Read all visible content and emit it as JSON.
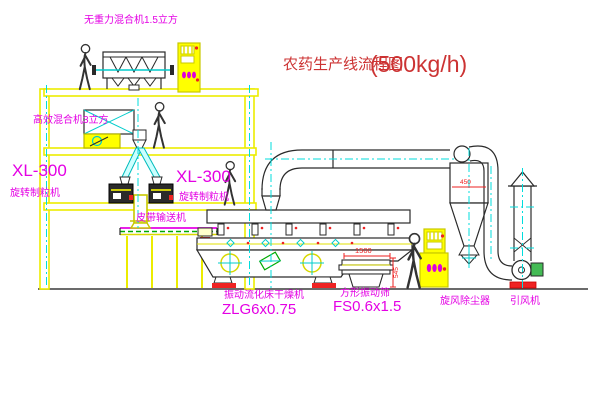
{
  "title": {
    "text": "农药生产线流程图",
    "capacity": "(500kg/h)"
  },
  "equipment": {
    "gravity_mixer": {
      "label": "无重力混合机1.5立方"
    },
    "high_efficiency_mixer": {
      "label": "高效混合机3立方"
    },
    "granulator_left": {
      "model": "XL-300",
      "name": "旋转制粒机"
    },
    "granulator_right": {
      "model": "XL-300",
      "name": "旋转制粒机"
    },
    "belt_conveyor": {
      "name": "皮带输送机"
    },
    "fluid_bed_dryer": {
      "name": "振动流化床干燥机",
      "model": "ZLG6x0.75"
    },
    "vibrating_sieve": {
      "name": "方形振动筛",
      "model": "FS0.6x1.5"
    },
    "cyclone": {
      "name": "旋风除尘器"
    },
    "fan": {
      "name": "引风机"
    }
  },
  "dimensions": {
    "sieve_length": "1500",
    "sieve_height": "545",
    "cyclone_inlet": "450"
  },
  "icons": {
    "cabinet_indicator": "indicator-lights",
    "center_mark": "crosshair-center-mark",
    "person": "human-figure"
  },
  "colors": {
    "structure_yellow": "#f0f000",
    "centerline_cyan": "#00dddd",
    "label_magenta": "#e400e4",
    "title_red": "#cc3333",
    "accent_red": "#ee2222",
    "belt_green": "#00aa00",
    "line_black": "#2a2a2a"
  }
}
